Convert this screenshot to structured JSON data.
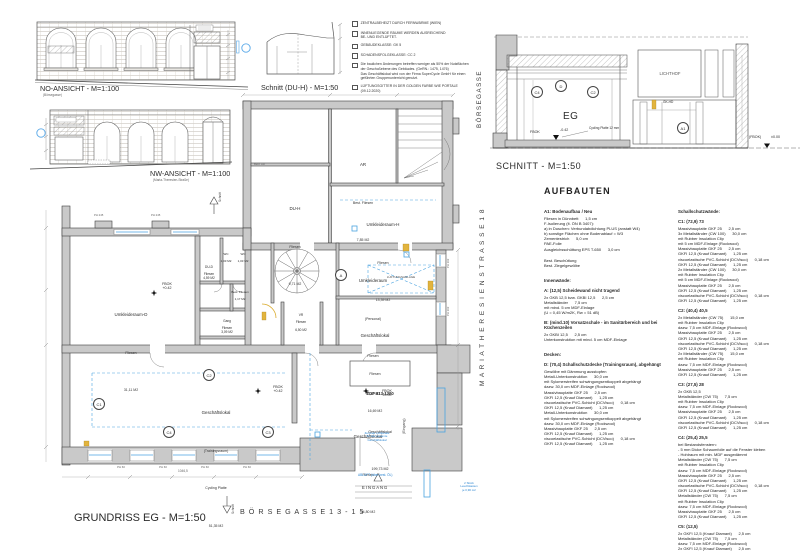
{
  "elevation_no": {
    "title": "NO-ANSICHT - M=1:100",
    "subtitle": "(Börsegasse)"
  },
  "elevation_nw": {
    "title": "NW-ANSICHT - M=1:100",
    "subtitle": "(Maria-Theresien-Straße)"
  },
  "schnitt_duh": {
    "title": "Schnitt (DU-H) - M=1:50"
  },
  "notes": {
    "n1": "ZENTRALBEHEIZT DURCH FERNWÄRME (WIEN)",
    "n2": "INNENLIEGENDE RÄUME WERDEN AUSREICHEND\nBE- UND ENTLÜFTET.",
    "n3": "GEBÄUDEKLASSE: GK 5",
    "n4": "SCHADENSFOLGEKLASSE: CC 2",
    "n5": "Die baulichen Änderungen betreffen weniger als 50% der Nutzflächen\nder Geschoßebene des Gebäudes. (GeRN.: 1475, 1476)\nDas Geschäftslokal wird von der Firma SuperCycle GmbH für einen\ngeführten Gruppenunterricht genutzt.",
    "n6": "LÜFTUNGSGITTER IN DER GOLDEN FARBE WIE PORTALE\n(09.12.2020)"
  },
  "schnitt": {
    "title": "SCHNITT - M=1:50",
    "street": "BÖRSEGASSE",
    "lichthof": "LICHTHOF",
    "eg": "EG",
    "fbok_left": "FBOK",
    "fbok_left_value": "-0.42",
    "cycling": "Cycling Platte 12 mm",
    "gkhd": "GK-HD",
    "fbok_right": "(FBOK)",
    "fbok_right_value": "±0.00",
    "m_c4": "C4",
    "m_d": "D",
    "m_c2": "C2",
    "m_a1": "A1"
  },
  "plan": {
    "title": "GRUNDRISS EG - M=1:50",
    "street_bottom": "B Ö R S E G A S S E  1 3 - 1 5",
    "street_right": "M A R I A  T H E R E S I E N  S T R A S S E  1 8",
    "schnitt_marker": "Schnitt",
    "best_ar": "Best. AR",
    "rooms": {
      "ar": {
        "name": "AR",
        "finish": "Best. Fliesen",
        "area": "7,85 M2"
      },
      "duh": {
        "name": "DU-H",
        "finish": "Fliesen",
        "area": "9,71 M2"
      },
      "umk_h": {
        "name": "Umkleideraum-H",
        "finish": "Fliesen",
        "area": "13,39 M2"
      },
      "umk_d": {
        "name": "Umkleideraum-D",
        "finish": "Fliesen",
        "area": "31,11 M2"
      },
      "dud": {
        "name": "DU-D",
        "finish": "Fliesen",
        "area": "4,59 M2"
      },
      "wc1": {
        "name": "WC",
        "area": "1,03 M2"
      },
      "wc2": {
        "name": "WC",
        "area": "1,03 M2"
      },
      "best": {
        "name": "Best. Fliesen",
        "area": "1,17 M2"
      },
      "gang": {
        "name": "Gang",
        "finish": "Fliesen",
        "area": "3,09 M2"
      },
      "vr": {
        "name": "VR",
        "finish": "Fliesen",
        "area": "6,50 M2"
      },
      "personal": {
        "name": "Umkleideraum",
        "sub": "(Personal)",
        "finish": "Fliesen",
        "area": "11,42 M2"
      },
      "g16": {
        "name": "Geschäftslokal",
        "finish": "Fliesen",
        "area": "16,69 M2"
      },
      "training": {
        "name": "Geschäftslokal",
        "sub": "(Trainingsraum)",
        "finish": "Cycling Platte",
        "area": "51,35 M2"
      },
      "g34": {
        "name": "Geschäftslokal",
        "finish": "Fliesen",
        "area": "34,80 M2"
      }
    },
    "top_unit": {
      "l1": "TOP 813-1300",
      "l2": "Geschäftslokal",
      "l3": "199,73 M2"
    },
    "levels": {
      "fbok000": "FBOK\n±0.00",
      "fbok042": "FBOK\n+0.42"
    },
    "lueftung": "LÜFTUNGSANLAGE",
    "eingang": "EINGANG",
    "eingang_v": "(Eingang)",
    "abluft": "ABLUFT (über best. ÖL)",
    "zentrale": "Zentrale Lüftkanäle\nfür das gesamte\nGeschäftslokal",
    "leuchtkasten": "2 Stück\nLeuchtkasten\nje 0,90 m2",
    "dim_total": "1046,5",
    "ph245": "PH 245",
    "ph60": "PH 60",
    "ph102": "PH 102",
    "markers": {
      "a": "A",
      "c1": "C1",
      "c2": "C2",
      "c3": "C3",
      "c4": "C4"
    }
  },
  "aufbauten": {
    "title": "AUFBAUTEN",
    "left": {
      "s0h": "A1: Bodenaufbau / Neu",
      "s0b": "Fliesen in Dünnbett      1,5 cm\nF-Isolierung (lt. ÖN B 3407):\na) in Duschen: Verbundabdichtung PLUS (anstatt W4)\nb) sonstige Flächen ohne Bodenablauf = W3\nZementestrich      5,0 cm\nPAE-Folie\nAusgleichsschüttung EPS T-650      3,0 cm",
      "s1b": "Best. Beschüttung\nBest. Ziegelgewölbe",
      "s2h": "Innenwände:",
      "s3h": "A: (12,5) Scheidewand nicht tragend",
      "s3b": "2x GKB 12,5 bzw. GKBI 12,5      2,5 cm\nMetallständer      7,5 cm\nmit mind. 5 cm MDF-Einlage\n(U = 0,45 W/m2K, Rw = 51 dB)",
      "s4h": "B: (mind.10) Vorsatzschale - im Sanitärbereich und bei Küchenzeilen",
      "s4b": "2x GKBI 12,5      2,5 cm\nUnterkonstruktion mit mind. 5 cm MDF-Einlage",
      "s5h": "Decken:",
      "s6h": "D: (70,4) Schallschutzdecke (Trainingsraum), abgehängt",
      "s6b": "Gewölbe mit Dämmung ausstopfen\nMetall-Unterkonstruktion      30,0 cm\nmit Sylomerstreifen schwingungsentkoppelt abgehängt\ndazw. 30,0 cm MDF-Einlage (Rockwool)\nMassivbauplatte GKF 25      2,5 cm\nGKFI 12,5 (Knauf Diamant)      1,25 cm\nviscoelastische PVC-Schicht (DCVisco)      0,18 cm\nGKFI 12,5 (Knauf Diamant)      1,25 cm\nMetall-Unterkonstruktion      30,0 cm\nmit Sylomerstreifen schwingungsentkoppelt abgehängt\ndazw. 30,0 cm MDF-Einlage (Rockwool)\nMassivbauplatte GKF 25      2,5 cm\nGKFI 12,5 (Knauf Diamant)      1,25 cm\nviscoelastische PVC-Schicht (DCVisco)      0,18 cm\nGKFI 12,5 (Knauf Diamant)      1,25 cm"
    },
    "right": {
      "s0h": "Schallschutzwände:",
      "s1h": "C1: (72,9) 73",
      "s1b": "Massivbauplatte GKF 25      2,5 cm\n3x Metallständer (CW 100)      30,0 cm\nmit Rubber Insulation Clip\nmit 5 cm MDF-Einlage (Rockwool)\nMassivbauplatte GKF 25      2,5 cm\nGKFI 12,5 (Knauf Diamant)      1,25 cm\nviscoelastische PVC-Schicht (DCVisco)      0,18 cm\nGKFI 12,5 (Knauf Diamant)      1,25 cm\n2x Metallständer (CW 100)      30,0 cm\nmit Rubber Insulation Clip\nmit 5 cm MDF-Einlage (Rockwool)\nMassivbauplatte GKF 25      2,5 cm\nGKFI 12,5 (Knauf Diamant)      1,25 cm\nviscoelastische PVC-Schicht (DCVisco)      0,18 cm\nGKFI 12,5 (Knauf Diamant)      1,25 cm",
      "s2h": "C2: (40,4) 40,5",
      "s2b": "2x Metallständer (CW 75)      15,0 cm\nmit Rubber Insulation Clip\ndazw. 7,5 cm MDF-Einlage (Rockwool)\nMassivbauplatte GKF 25      2,5 cm\nGKFI 12,5 (Knauf Diamant)      1,25 cm\nviscoelastische PVC-Schicht (DCVisco)      0,18 cm\nGKFI 12,5 (Knauf Diamant)      1,25 cm\n2x Metallständer (CW 75)      15,0 cm\nmit Rubber Insulation Clip\ndazw. 7,5 cm MDF-Einlage (Rockwool)\nMassivbauplatte GKF 25      2,5 cm\nGKFI 12,5 (Knauf Diamant)      1,25 cm",
      "s3h": "C3: (27,5) 28",
      "s3b": "2x GKB 12,5\nMetallständer (CW 75)      7,5 cm\nmit Rubber Insulation Clip\ndazw. 7,5 cm MDF-Einlage (Rockwool)\nMassivbauplatte GKF 25      2,5 cm\nGKFI 12,5 (Knauf Diamant)      1,25 cm\nviscoelastische PVC-Schicht (DCVisco)      0,18 cm\nGKFI 12,5 (Knauf Diamant)      1,25 cm",
      "s4h": "C4: (25,4) 25,5",
      "s4b": "bei Bestandsfenstern:\n- 5 mm Dicke Schaumfolie auf die Fenster kleben\n- Hohlraum mit min. MDF ausgedämmt\nMetallständer (CW 75)      7,5 cm\nmit Rubber Insulation Clip\ndazw. 7,5 cm MDF-Einlage (Rockwool)\nMassivbauplatte GKF 25      2,5 cm\nGKFI 12,5 (Knauf Diamant)      1,25 cm\nviscoelastische PVC-Schicht (DCVisco)      0,18 cm\nGKFI 12,5 (Knauf Diamant)      1,25 cm\nMetallständer (CW 75)      7,5 cm\nmit Rubber Insulation Clip\ndazw. 7,5 cm MDF-Einlage (Rockwool)\nMassivbauplatte GKF 25      2,5 cm\nGKFI 12,5 (Knauf Diamant)      1,25 cm",
      "s5h": "C5: (12,5)",
      "s5b": "2x GKFI 12,5 (Knauf Diamant)      2,5 cm\nMetallständer (CW 75)      7,5 cm\ndazw. 7,5 cm MDF-Einlage (Rockwool)\n2x GKFI 12,5 (Knauf Diamant)      2,5 cm"
    }
  }
}
